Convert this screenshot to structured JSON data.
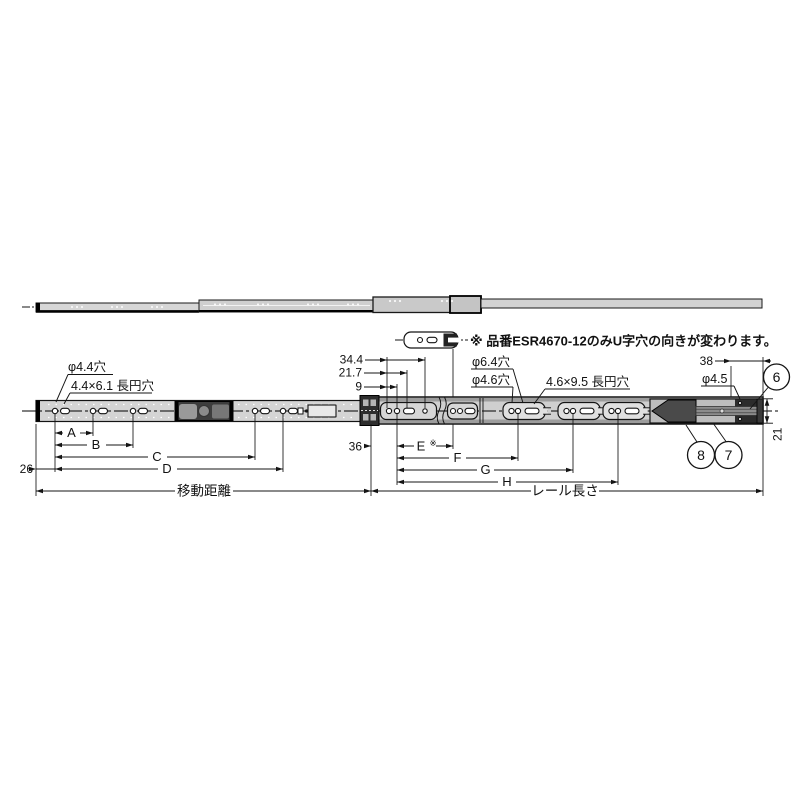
{
  "drawing": {
    "title_context": "telescopic-slide-rail-technical-drawing",
    "note": "※ 品番ESR4670-12のみU字穴の向きが変わります。",
    "callouts": {
      "hole44": "φ4.4穴",
      "slot44": "4.4×6.1 長円穴",
      "hole64": "φ6.4穴",
      "hole46": "φ4.6穴",
      "slot46": "4.6×9.5 長円穴",
      "hole45": "φ4.5"
    },
    "dims": {
      "d344": "34.4",
      "d217": "21.7",
      "d9": "9",
      "d38": "38",
      "d36": "36",
      "d26": "26",
      "d21": "21",
      "A": "A",
      "B": "B",
      "C": "C",
      "D": "D",
      "E": "E",
      "E_mark": "※",
      "F": "F",
      "G": "G",
      "H": "H",
      "travel": "移動距離",
      "rail_length": "レール長さ"
    },
    "balloons": {
      "b6": "6",
      "b7": "7",
      "b8": "8"
    },
    "colors": {
      "line": "#141414",
      "rail_fill": "#cfcfcf",
      "rail_light": "#d6d6d6",
      "rail_band": "#9d9d9d",
      "mech_dark": "#3d3d3d",
      "background": "#ffffff"
    }
  }
}
